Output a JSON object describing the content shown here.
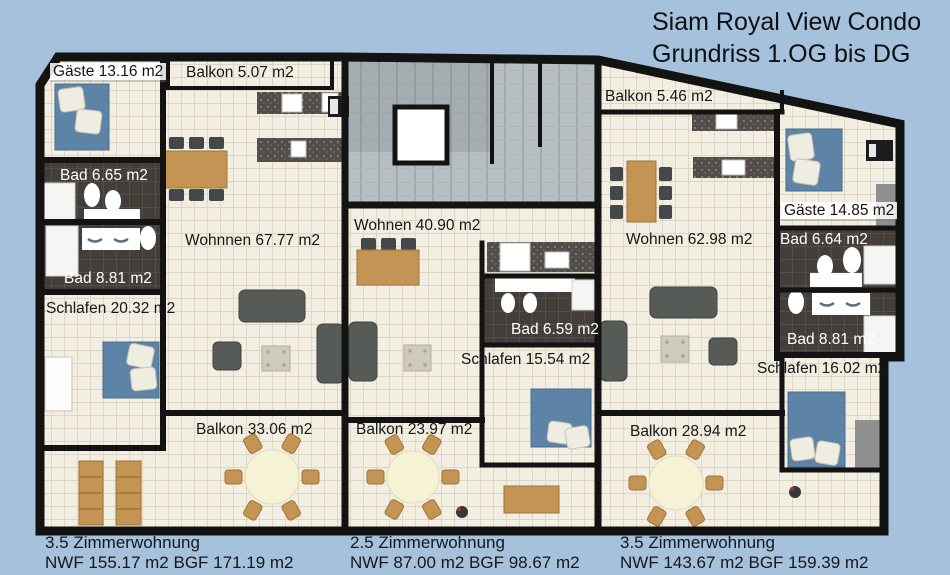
{
  "title": {
    "line1": "Siam Royal View Condo",
    "line2": "Grundriss 1.OG bis DG"
  },
  "apartments": {
    "left": {
      "labels": {
        "gaeste": "Gäste 13.16 m2",
        "balkon_top": "Balkon 5.07 m2",
        "bad_small": "Bad 6.65 m2",
        "bad_large": "Bad 8.81 m2",
        "wohnen": "Wohnnen 67.77 m2",
        "schlafen": "Schlafen 20.32 m2",
        "balkon": "Balkon 33.06 m2"
      },
      "summary_line1": "3.5 Zimmerwohnung",
      "summary_line2": "NWF 155.17 m2 BGF 171.19 m2"
    },
    "middle": {
      "labels": {
        "wohnen": "Wohnen 40.90 m2",
        "bad": "Bad 6.59 m2",
        "schlafen": "Schlafen 15.54 m2",
        "balkon": "Balkon 23.97 m2"
      },
      "summary_line1": "2.5 Zimmerwohnung",
      "summary_line2": "NWF 87.00 m2 BGF 98.67 m2"
    },
    "right": {
      "labels": {
        "balkon_top": "Balkon 5.46 m2",
        "wohnen": "Wohnen 62.98 m2",
        "gaeste": "Gäste 14.85 m2",
        "bad_small": "Bad 6.64 m2",
        "bad_large": "Bad 8.81 m2",
        "schlafen": "Schlafen 16.02 m2",
        "balkon": "Balkon 28.94 m2"
      },
      "summary_line1": "3.5 Zimmerwohnung",
      "summary_line2": "NWF 143.67 m2 BGF 159.39 m2"
    }
  },
  "colors": {
    "background": "#a5c1dc",
    "wall": "#131313",
    "floor_tile": "#f3eee2",
    "bath_tile": "#433e39",
    "stairwell_tile": "#b7bec2",
    "bed_blue": "#5d83a7",
    "wood": "#c49455",
    "sofa_gray": "#575b57",
    "counter_granite": "#524d48"
  }
}
